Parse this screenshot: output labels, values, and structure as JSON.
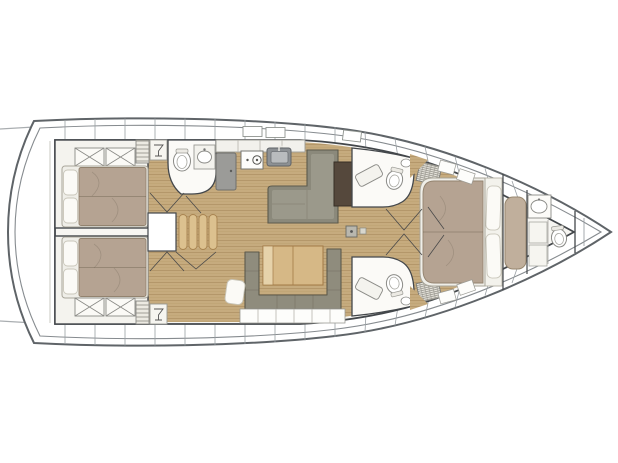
{
  "meta": {
    "description": "Top-down interior layout plan of a sailing yacht, bow pointing right",
    "diagram_type": "boat-floor-plan"
  },
  "vessel": {
    "orientation": "bow-right",
    "rooms": [
      {
        "id": "aft-cabin-port",
        "label": "Aft port cabin with double berth, pillows and cross-hatched lockers"
      },
      {
        "id": "aft-cabin-starboard",
        "label": "Aft starboard cabin with double berth, pillows and cross-hatched lockers"
      },
      {
        "id": "day-head",
        "label": "Amidships day head with toilet and washbasin"
      },
      {
        "id": "galley",
        "label": "Galley with refrigerator, two-burner stove and sink"
      },
      {
        "id": "companionway",
        "label": "Companionway steps with landing"
      },
      {
        "id": "saloon",
        "label": "Saloon with L-shaped settee and dark nav table"
      },
      {
        "id": "dinette",
        "label": "Dinette with U-shaped sofa, folding wood table and cushion"
      },
      {
        "id": "head-forward-port",
        "label": "Forward port head with toilet, basin and shower bench"
      },
      {
        "id": "head-forward-starboard",
        "label": "Forward starboard head with toilet, basin and shower bench"
      },
      {
        "id": "owner-cabin",
        "label": "Owner's cabin in bow with island double berth, pillows and bench seat"
      },
      {
        "id": "ensuite-head",
        "label": "En-suite forward head with washbasin and toilet"
      },
      {
        "id": "bow-locker",
        "label": "Bow anchor / sail locker"
      }
    ],
    "fixtures": [
      "double-berth",
      "pillow",
      "locker-x-hatch",
      "shelf-unit",
      "hanging-locker",
      "toilet",
      "washbasin",
      "stove-two-burner",
      "sink",
      "refrigerator",
      "stairs",
      "l-settee",
      "nav-table",
      "u-sofa",
      "saloon-table",
      "bench-seat",
      "mast-foot",
      "deck-hatch"
    ]
  },
  "palette": {
    "hull_outline": "#5f6468",
    "inner_hull": "#868b8f",
    "bulkhead": "#43474b",
    "floor_wood": "#c6ab7e",
    "floor_plank_line": "#ab8d5e",
    "berth_linen": "#b5a392",
    "mattress": "#efeee8",
    "pillow": "#fbfaf6",
    "sofa_gray": "#8f8c7d",
    "table_wood": "#d6b886",
    "table_leaf": "#e6d2aa",
    "cabinet_gray": "#9b9b98",
    "sink_gray": "#8d9194",
    "nav_table_dark": "#55483c",
    "room_white": "#f7f6f2",
    "step_wood": "#dcc18f"
  }
}
